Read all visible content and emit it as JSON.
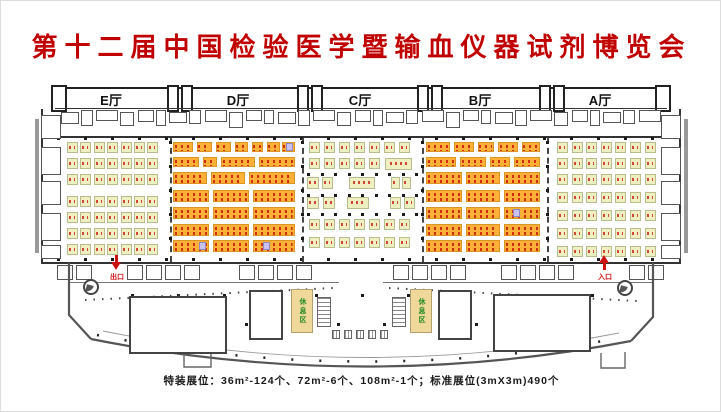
{
  "title": "第十二届中国检验医学暨输血仪器试剂博览会",
  "footer": "特装展位：36m²-124个、72m²-6个、108m²-1个；标准展位(3mX3m)490个",
  "labels": {
    "exit": "出口",
    "entrance": "入口",
    "lounge": "休息区"
  },
  "colors": {
    "title_red": "#c00000",
    "booth_green_fill": "#f0efc2",
    "booth_green_border": "#b9bd8e",
    "booth_orange_fill": "#ffb137",
    "booth_number_red": "#cc2211",
    "lounge_fill": "#f0d89b",
    "lounge_text_green": "#1f8a1f",
    "wall": "#333333",
    "arrow_red": "#cc1111"
  },
  "floorplan": {
    "halls": [
      {
        "name": "E厅",
        "label_x": 110,
        "booths": {
          "type": "grid",
          "x0": 66,
          "pitch_x": 13.4,
          "cols": 7,
          "rows_y": [
            141,
            157,
            173,
            195,
            211,
            227,
            243
          ],
          "w": 11,
          "h": 11,
          "style": "green"
        }
      },
      {
        "name": "D厅",
        "label_x": 237,
        "booths": {
          "type": "strips",
          "rows": [
            {
              "y": 141,
              "h": 10,
              "segs": [
                [
                  172,
                  20
                ],
                [
                  196,
                  15
                ],
                [
                  215,
                  15
                ],
                [
                  234,
                  13
                ],
                [
                  251,
                  11
                ],
                [
                  266,
                  13
                ],
                [
                  281,
                  13
                ]
              ]
            },
            {
              "y": 156,
              "h": 10,
              "segs": [
                [
                  172,
                  26
                ],
                [
                  202,
                  14
                ],
                [
                  220,
                  34
                ],
                [
                  258,
                  36
                ]
              ]
            },
            {
              "y": 171,
              "h": 12,
              "segs": [
                [
                  172,
                  34
                ],
                [
                  210,
                  34
                ],
                [
                  248,
                  46
                ]
              ]
            },
            {
              "y": 189,
              "h": 12,
              "segs": [
                [
                  172,
                  36
                ],
                [
                  212,
                  36
                ],
                [
                  252,
                  42
                ]
              ]
            },
            {
              "y": 206,
              "h": 12,
              "segs": [
                [
                  172,
                  36
                ],
                [
                  212,
                  36
                ],
                [
                  252,
                  42
                ]
              ]
            },
            {
              "y": 223,
              "h": 12,
              "segs": [
                [
                  172,
                  36
                ],
                [
                  212,
                  36
                ],
                [
                  252,
                  42
                ]
              ]
            },
            {
              "y": 239,
              "h": 12,
              "segs": [
                [
                  172,
                  36
                ],
                [
                  212,
                  36
                ],
                [
                  252,
                  42
                ]
              ]
            }
          ]
        }
      },
      {
        "name": "C厅",
        "label_x": 359,
        "booths": {
          "type": "list",
          "items": [
            [
              308,
              141,
              11,
              11
            ],
            [
              323,
              141,
              11,
              11
            ],
            [
              338,
              141,
              11,
              11
            ],
            [
              353,
              141,
              11,
              11
            ],
            [
              368,
              141,
              11,
              11
            ],
            [
              383,
              141,
              11,
              11
            ],
            [
              398,
              141,
              11,
              11
            ],
            [
              308,
              157,
              11,
              11
            ],
            [
              323,
              157,
              11,
              11
            ],
            [
              338,
              157,
              11,
              11
            ],
            [
              353,
              157,
              11,
              11
            ],
            [
              368,
              157,
              11,
              11
            ],
            [
              384,
              157,
              27,
              12
            ],
            [
              306,
              176,
              12,
              12
            ],
            [
              321,
              176,
              11,
              12
            ],
            [
              348,
              176,
              26,
              12
            ],
            [
              390,
              176,
              9,
              12
            ],
            [
              401,
              176,
              9,
              12
            ],
            [
              306,
              196,
              12,
              12
            ],
            [
              322,
              196,
              12,
              12
            ],
            [
              346,
              196,
              22,
              12
            ],
            [
              389,
              196,
              11,
              12
            ],
            [
              403,
              196,
              11,
              12
            ],
            [
              308,
              218,
              11,
              11
            ],
            [
              323,
              218,
              11,
              11
            ],
            [
              338,
              218,
              11,
              11
            ],
            [
              353,
              218,
              11,
              11
            ],
            [
              368,
              218,
              11,
              11
            ],
            [
              383,
              218,
              11,
              11
            ],
            [
              398,
              218,
              11,
              11
            ],
            [
              308,
              236,
              11,
              11
            ],
            [
              323,
              236,
              11,
              11
            ],
            [
              338,
              236,
              11,
              11
            ],
            [
              353,
              236,
              11,
              11
            ],
            [
              368,
              236,
              11,
              11
            ],
            [
              383,
              236,
              11,
              11
            ],
            [
              398,
              236,
              11,
              11
            ]
          ]
        }
      },
      {
        "name": "B厅",
        "label_x": 479,
        "booths": {
          "type": "strips",
          "rows": [
            {
              "y": 141,
              "h": 10,
              "segs": [
                [
                  425,
                  24
                ],
                [
                  453,
                  20
                ],
                [
                  477,
                  16
                ],
                [
                  497,
                  20
                ],
                [
                  521,
                  18
                ]
              ]
            },
            {
              "y": 156,
              "h": 10,
              "segs": [
                [
                  425,
                  30
                ],
                [
                  459,
                  26
                ],
                [
                  489,
                  20
                ],
                [
                  513,
                  26
                ]
              ]
            },
            {
              "y": 171,
              "h": 12,
              "segs": [
                [
                  425,
                  36
                ],
                [
                  465,
                  34
                ],
                [
                  503,
                  36
                ]
              ]
            },
            {
              "y": 189,
              "h": 12,
              "segs": [
                [
                  425,
                  36
                ],
                [
                  465,
                  34
                ],
                [
                  503,
                  36
                ]
              ]
            },
            {
              "y": 206,
              "h": 12,
              "segs": [
                [
                  425,
                  36
                ],
                [
                  465,
                  34
                ],
                [
                  503,
                  36
                ]
              ]
            },
            {
              "y": 223,
              "h": 12,
              "segs": [
                [
                  425,
                  36
                ],
                [
                  465,
                  34
                ],
                [
                  503,
                  36
                ]
              ]
            },
            {
              "y": 239,
              "h": 12,
              "segs": [
                [
                  425,
                  36
                ],
                [
                  465,
                  34
                ],
                [
                  503,
                  36
                ]
              ]
            }
          ]
        }
      },
      {
        "name": "A厅",
        "label_x": 599,
        "booths": {
          "type": "grid",
          "x0": 556,
          "pitch_x": 14.6,
          "cols": 7,
          "rows_y": [
            141,
            157,
            173,
            191,
            209,
            227,
            245
          ],
          "w": 11,
          "h": 11,
          "style": "green"
        }
      }
    ],
    "dividers_x": [
      169,
      301,
      421,
      546
    ],
    "purple_cells": [
      [
        198,
        241
      ],
      [
        262,
        241
      ],
      [
        285,
        142
      ],
      [
        512,
        208
      ]
    ]
  }
}
